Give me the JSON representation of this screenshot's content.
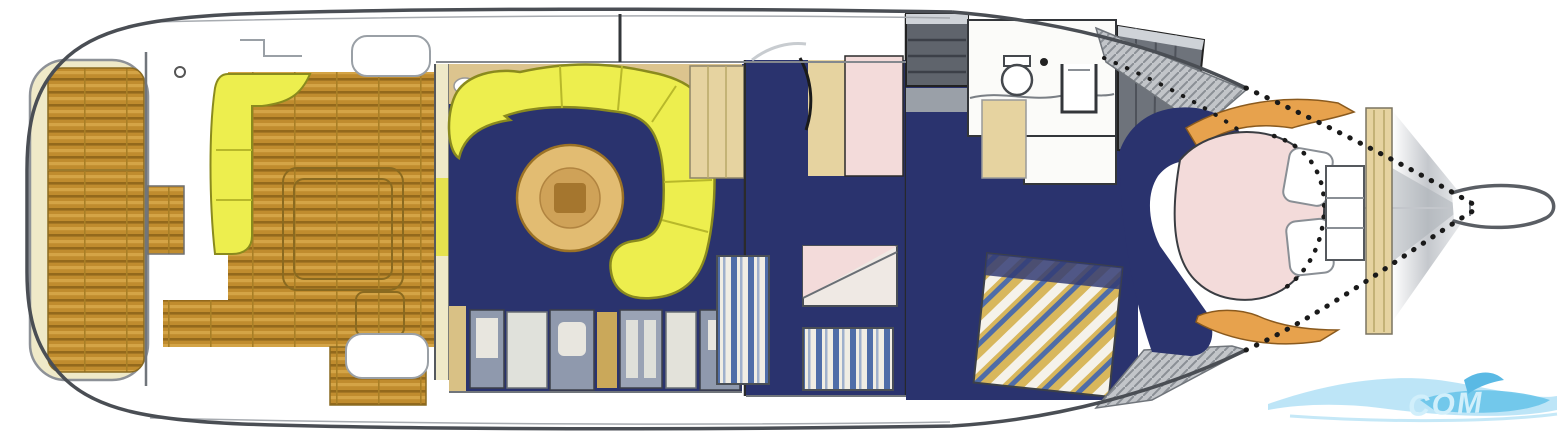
{
  "figure": {
    "type": "boat-floor-plan",
    "description": "Top-down yacht deck and accommodation plan, stern at left, bow at right"
  },
  "watermark": {
    "text": "COM",
    "color": "#5bbfe8"
  },
  "palette": {
    "hull_outline": "#4a4e54",
    "deck_teak": "#c08c2e",
    "teak_line": "#93691c",
    "floor_navy": "#2a336e",
    "sofa_yellow": "#edee4e",
    "bed_pink": "#f3dbda",
    "cabinet_tan": "#e6d3a0",
    "table_wood": "#e2bc72",
    "table_inner": "#cfa258",
    "shelf_orange": "#e7a24d",
    "hatch_gray": "#c2c5c9",
    "appliance_gray": "#8f99ad",
    "bulkhead_cream": "#efe9c8",
    "watermark_blue": "#5bbfe8",
    "watermark_light": "#9ed9f4"
  },
  "regions": [
    {
      "id": "swim-platform",
      "label": "Swim platform"
    },
    {
      "id": "aft-deck",
      "label": "Aft cockpit teak deck"
    },
    {
      "id": "cockpit-bench",
      "label": "Cockpit bench seat"
    },
    {
      "id": "engine-hatch",
      "label": "Engine hatch"
    },
    {
      "id": "salon",
      "label": "Salon"
    },
    {
      "id": "salon-sofa",
      "label": "Curved salon sofa"
    },
    {
      "id": "salon-table",
      "label": "Round salon table"
    },
    {
      "id": "galley",
      "label": "Galley"
    },
    {
      "id": "mid-cabin",
      "label": "Mid cabin"
    },
    {
      "id": "guest-berths",
      "label": "Guest berths"
    },
    {
      "id": "companionway",
      "label": "Companionway steps"
    },
    {
      "id": "head",
      "label": "Head / bathroom"
    },
    {
      "id": "side-decks",
      "label": "Side decks"
    },
    {
      "id": "forward-cabin",
      "label": "Forward cabin"
    },
    {
      "id": "forward-berth",
      "label": "Forward island berth"
    },
    {
      "id": "bow",
      "label": "Bow"
    },
    {
      "id": "bow-pulpit",
      "label": "Bow pulpit"
    }
  ]
}
